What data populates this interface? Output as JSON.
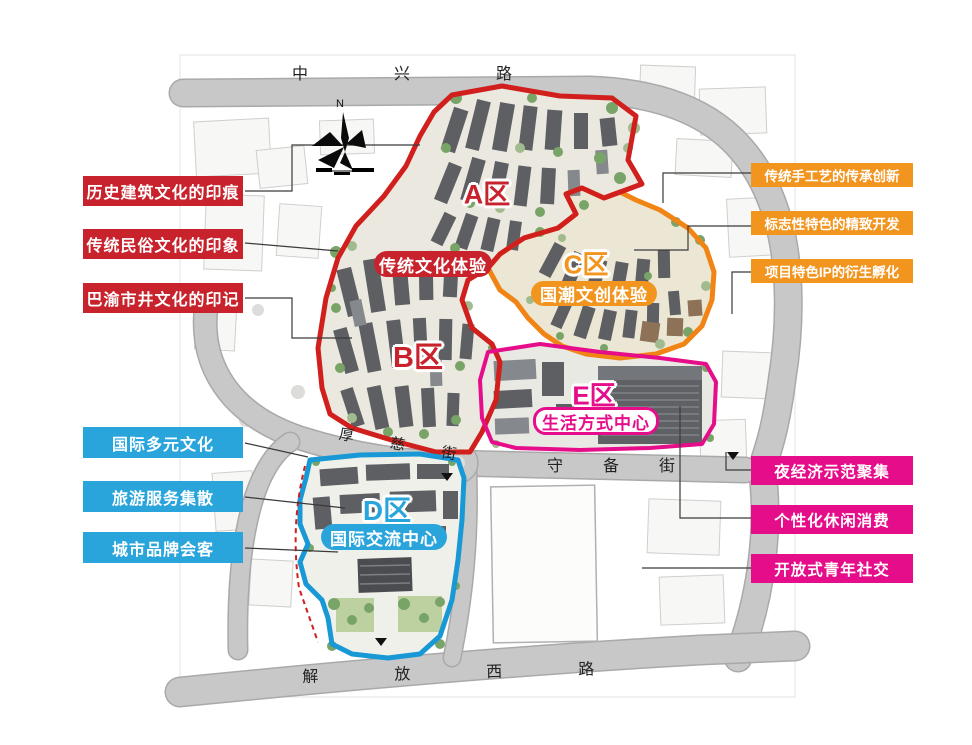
{
  "map": {
    "compass_label": "N",
    "roads": {
      "top": "中兴路",
      "houci": "厚慈街",
      "shoubei": "守备街",
      "bottom": "解放西路"
    },
    "zones": [
      {
        "id": "A",
        "letter": "A区",
        "pill": "传统文化体验"
      },
      {
        "id": "B",
        "letter": "B区"
      },
      {
        "id": "C",
        "letter": "C区",
        "pill": "国潮文创体验"
      },
      {
        "id": "D",
        "letter": "D区",
        "pill": "国际交流中心"
      },
      {
        "id": "E",
        "letter": "E区",
        "pill": "生活方式中心"
      }
    ],
    "callouts_left_red": [
      "历史建筑文化的印痕",
      "传统民俗文化的印象",
      "巴渝市井文化的印记"
    ],
    "callouts_left_blue": [
      "国际多元文化",
      "旅游服务集散",
      "城市品牌会客"
    ],
    "callouts_right_orange": [
      "传统手工艺的传承创新",
      "标志性特色的精致开发",
      "项目特色IP的衍生孵化"
    ],
    "callouts_right_magenta": [
      "夜经济示范聚集",
      "个性化休闲消费",
      "开放式青年社交"
    ],
    "colors": {
      "red": "#c8232c",
      "orange": "#f2951f",
      "blue": "#2aa5dc",
      "magenta": "#e60d8a",
      "boundary_red": "#d01f1c",
      "boundary_orange": "#f08414",
      "boundary_blue": "#1899d6",
      "boundary_magenta": "#e60d8a",
      "road_grey": "#c8c8c8",
      "building_grey": "#5d5f63"
    }
  }
}
